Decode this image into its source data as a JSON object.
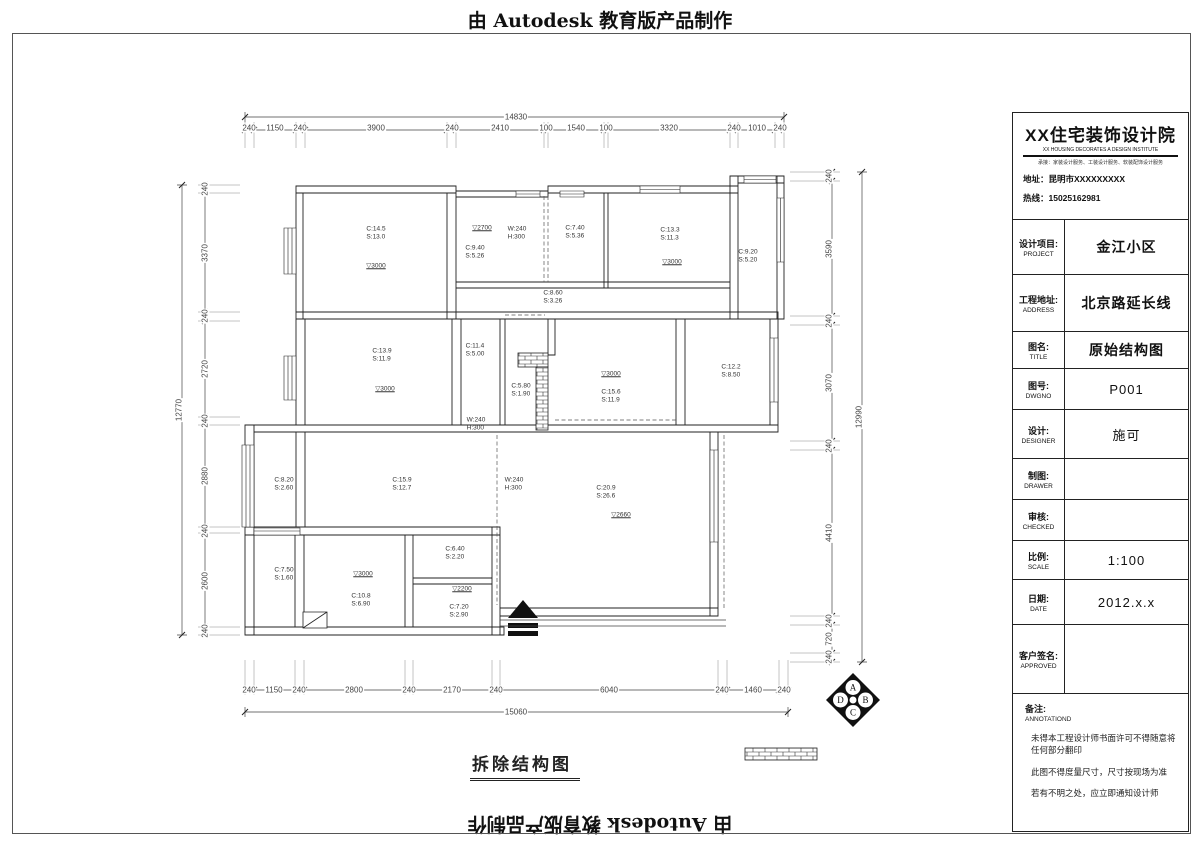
{
  "banner": {
    "top": "由 Autodesk 教育版产品制作",
    "bottom": "由 Autodesk 教育版产品制作"
  },
  "title_block": {
    "institute": {
      "name": "XX住宅装饰设计院",
      "name_en": "XX HOUSING DECORATES A DESIGN INSTITUTE",
      "tagline": "承接：家装设计服务、工装设计服务、软装配饰设计服务",
      "address": "地址：昆明市XXXXXXXXX",
      "hotline": "热线：15025162981"
    },
    "rows": [
      {
        "label_cn": "设计项目:",
        "label_en": "PROJECT",
        "value": "金江小区"
      },
      {
        "label_cn": "工程地址:",
        "label_en": "ADDRESS",
        "value": "北京路延长线"
      },
      {
        "label_cn": "图名:",
        "label_en": "TITLE",
        "value": "原始结构图"
      },
      {
        "label_cn": "图号:",
        "label_en": "DWGNO",
        "value": "P001"
      },
      {
        "label_cn": "设计:",
        "label_en": "DESIGNER",
        "value": "施可"
      },
      {
        "label_cn": "制图:",
        "label_en": "DRAWER",
        "value": ""
      },
      {
        "label_cn": "审核:",
        "label_en": "CHECKED",
        "value": ""
      },
      {
        "label_cn": "比例:",
        "label_en": "SCALE",
        "value": "1:100"
      },
      {
        "label_cn": "日期:",
        "label_en": "DATE",
        "value": "2012.x.x"
      },
      {
        "label_cn": "客户签名:",
        "label_en": "APPROVED",
        "value": ""
      }
    ],
    "annotation": {
      "label_cn": "备注:",
      "label_en": "ANNOTATIOND",
      "notes": [
        "未得本工程设计师书面许可不得随意将任何部分翻印",
        "此图不得度量尺寸，尺寸按现场为准",
        "若有不明之处，应立即通知设计师"
      ]
    }
  },
  "plan": {
    "caption": "拆除结构图",
    "dims": {
      "top_total": "14830",
      "top": [
        "240",
        "1150",
        "240",
        "3900",
        "240",
        "2410",
        "100",
        "1540",
        "100",
        "3320",
        "240",
        "1010",
        "240"
      ],
      "bottom_total": "15060",
      "bottom": [
        "240",
        "1150",
        "240",
        "2800",
        "240",
        "2170",
        "240",
        "6040",
        "240",
        "1460",
        "240"
      ],
      "left_total": "12770",
      "left": [
        "240",
        "3370",
        "240",
        "2720",
        "240",
        "2880",
        "240",
        "2600",
        "240"
      ],
      "right_total": "12990",
      "right": [
        "240",
        "3590",
        "240",
        "3070",
        "240",
        "4410",
        "240",
        "720",
        "240"
      ]
    },
    "rooms": [
      {
        "c": "C:14.5",
        "s": "S:13.0"
      },
      {
        "c": "C:9.40",
        "s": "S:5.26"
      },
      {
        "c": "C:7.40",
        "s": "S:5.36"
      },
      {
        "c": "C:13.3",
        "s": "S:11.3"
      },
      {
        "c": "C:9.20",
        "s": "S:5.20"
      },
      {
        "c": "C:8.60",
        "s": "S:3.26"
      },
      {
        "c": "C:13.9",
        "s": "S:11.9"
      },
      {
        "c": "C:11.4",
        "s": "S:5.00"
      },
      {
        "c": "C:5.80",
        "s": "S:1.90"
      },
      {
        "c": "C:15.6",
        "s": "S:11.9"
      },
      {
        "c": "C:12.2",
        "s": "S:8.50"
      },
      {
        "c": "C:8.20",
        "s": "S:2.60"
      },
      {
        "c": "C:15.9",
        "s": "S:12.7"
      },
      {
        "c": "C:20.9",
        "s": "S:26.6"
      },
      {
        "c": "C:7.50",
        "s": "S:1.60"
      },
      {
        "c": "C:10.8",
        "s": "S:6.90"
      },
      {
        "c": "C:6.40",
        "s": "S:2.20"
      },
      {
        "c": "C:7.20",
        "s": "S:2.90"
      }
    ],
    "levels": [
      "▽3000",
      "▽2700",
      "▽3000",
      "▽3000",
      "▽3000",
      "▽2660",
      "▽3000",
      "▽2200"
    ],
    "wall_notes": [
      {
        "w": "W:240",
        "h": "H:300"
      },
      {
        "w": "W:240",
        "h": "H:300"
      },
      {
        "w": "W:240",
        "h": "H:300"
      }
    ],
    "compass": {
      "a": "A",
      "b": "B",
      "c": "C",
      "d": "D"
    }
  }
}
